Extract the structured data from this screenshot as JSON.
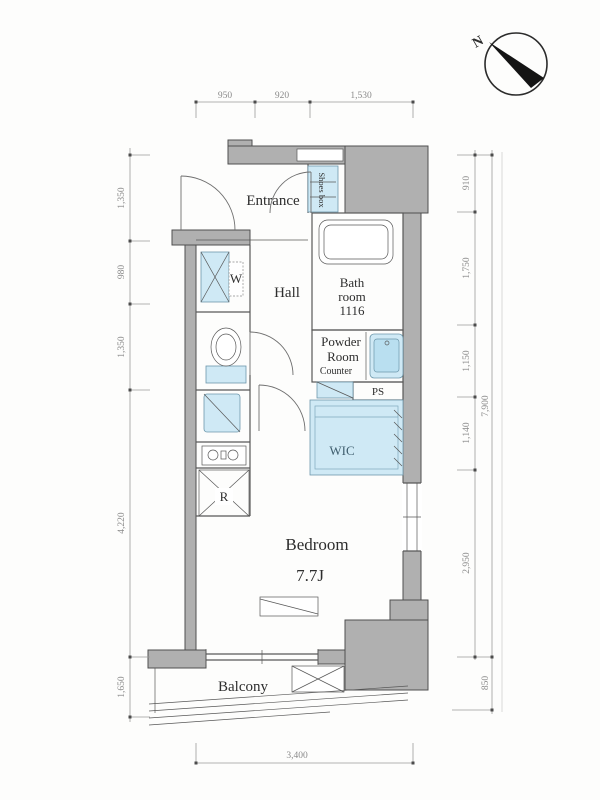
{
  "compass": {
    "north_label": "N"
  },
  "rooms": {
    "entrance": "Entrance",
    "shoes_box": "Shoes box",
    "bath_line1": "Bath",
    "bath_line2": "room",
    "bath_line3": "1116",
    "hall": "Hall",
    "washer": "W",
    "powder_line1": "Powder",
    "powder_line2": "Room",
    "counter": "Counter",
    "pipe_space": "PS",
    "wic": "WIC",
    "refrigerator": "R",
    "bedroom": "Bedroom",
    "bedroom_size": "7.7J",
    "balcony": "Balcony"
  },
  "dimensions": {
    "top": [
      "950",
      "920",
      "1,530"
    ],
    "left": [
      "1,350",
      "980",
      "1,350",
      "4,220",
      "1,650"
    ],
    "right": [
      "910",
      "1,750",
      "1,150",
      "1,140",
      "2,950"
    ],
    "right_total": "7,900",
    "right_balcony": "850",
    "bottom": "3,400"
  },
  "colors": {
    "wall_fill": "#b0b0b0",
    "wall_stroke": "#4f4f4f",
    "line": "#585858",
    "fixture_blue": "#cfe9f5",
    "fixture_blue_deep": "#b9dff0",
    "dim_text": "#8a8a8a",
    "label_text": "#2e2e2e"
  }
}
